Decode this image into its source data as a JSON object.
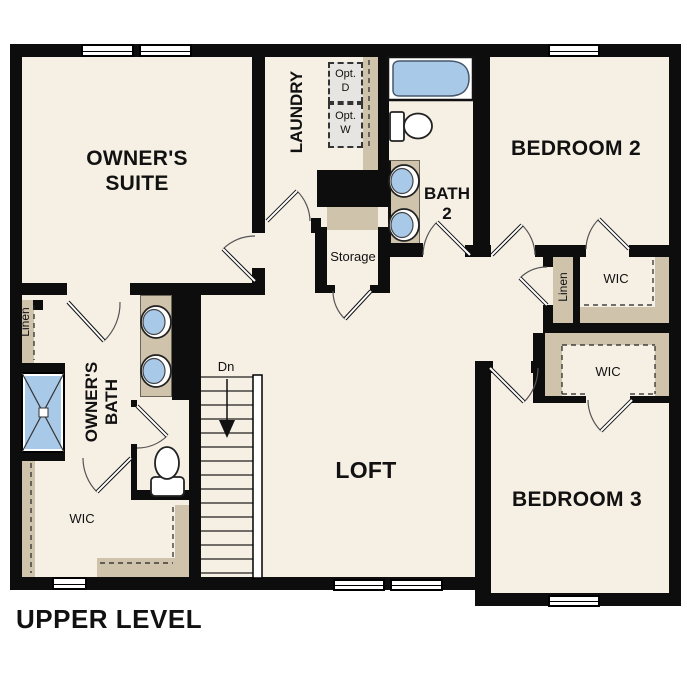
{
  "title": "UPPER LEVEL",
  "colors": {
    "floor": "#f6efe4",
    "cabinet_tan": "#cfc3ab",
    "fixture_blue": "#a9c9e8",
    "wall_black": "#0d0d0d",
    "optional_box_gray": "#e7e5e1"
  },
  "rooms": {
    "owners_suite": {
      "line1": "OWNER'S",
      "line2": "SUITE"
    },
    "laundry": {
      "label": "LAUNDRY"
    },
    "bedroom2": {
      "label": "BEDROOM 2"
    },
    "bath2": {
      "line1": "BATH",
      "line2": "2"
    },
    "storage": {
      "label": "Storage"
    },
    "loft": {
      "label": "LOFT"
    },
    "owners_bath": {
      "line1": "OWNER'S",
      "line2": "BATH"
    },
    "owners_wic": {
      "label": "WIC"
    },
    "bedroom2_wic": {
      "label": "WIC"
    },
    "bedroom3_wic": {
      "label": "WIC"
    },
    "bedroom3": {
      "label": "BEDROOM 3"
    },
    "linen_left": {
      "label": "Linen"
    },
    "linen_right": {
      "label": "Linen"
    },
    "stairs": {
      "direction_label": "Dn"
    }
  },
  "laundry_options": {
    "dryer": {
      "line1": "Opt.",
      "line2": "D"
    },
    "washer": {
      "line1": "Opt.",
      "line2": "W"
    }
  }
}
